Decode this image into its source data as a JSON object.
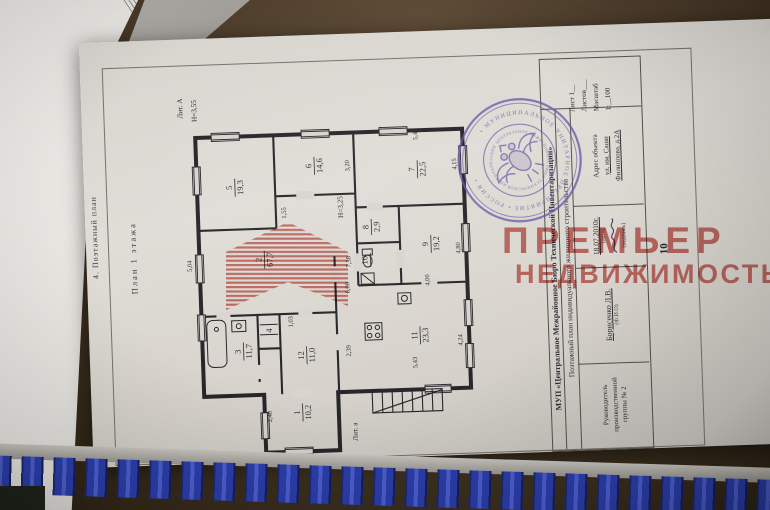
{
  "page": {
    "page_number": "10",
    "section_title": "4. Поэтажный план",
    "plan_title": "План 1 этажа"
  },
  "title_block": {
    "org": "МУП «Центральное Межрайонное Бюро Технической Инвентаризации»",
    "doc_type": "Поэтажный план индивидуального жилищного строительства",
    "sheet_lines": {
      "l1": "Лист 1__",
      "l2": "Листов___",
      "l3": "Масштаб",
      "l4": "1:__100"
    },
    "address": {
      "label": "Адрес объекта",
      "street": "ул. им. Саши",
      "house": "Филиппова, д.2А"
    },
    "date": {
      "value": "18.07.2010г.",
      "caption": "(дата)",
      "sign_caption": "(подпись)"
    },
    "executive": {
      "name": "Борисенко Л.В.",
      "caption": "(Ф.И.О)"
    },
    "role": {
      "l1": "Руководитель",
      "l2": "производственной",
      "l3": "группы № 2"
    }
  },
  "plan": {
    "rooms": [
      {
        "n": "5",
        "a": "19,3"
      },
      {
        "n": "6",
        "a": "14,6"
      },
      {
        "n": "7",
        "a": "22,5"
      },
      {
        "n": "8",
        "a": "2,9"
      },
      {
        "n": "9",
        "a": "19,2"
      },
      {
        "n": "10",
        "a": ""
      },
      {
        "n": "2",
        "a": "67,7"
      },
      {
        "n": "3",
        "a": "11,7"
      },
      {
        "n": "4",
        "a": ""
      },
      {
        "n": "12",
        "a": "11,0"
      },
      {
        "n": "11",
        "a": "23,3"
      },
      {
        "n": "1",
        "a": "10,2"
      }
    ],
    "dims": [
      {
        "t": "Лит. А"
      },
      {
        "t": "Н=3,55"
      },
      {
        "t": "Н=3,25"
      },
      {
        "t": "5,04"
      },
      {
        "t": "1,55"
      },
      {
        "t": "3,20"
      },
      {
        "t": "5,43"
      },
      {
        "t": "4,15"
      },
      {
        "t": "4,80"
      },
      {
        "t": "4,00"
      },
      {
        "t": "4,24"
      },
      {
        "t": "5,43"
      },
      {
        "t": "2,39"
      },
      {
        "t": "1,03"
      },
      {
        "t": "7,58"
      },
      {
        "t": "6,00"
      },
      {
        "t": "2,40"
      },
      {
        "t": "Лит. а"
      }
    ]
  },
  "stamp": {
    "outer_text": "• МУНИЦИПАЛЬНОЕ УНИТАРНОЕ ПРЕДПРИЯТИЕ • РОССИЯ •",
    "inner_text": "ЦЕНТРАЛЬНОЕ МЕЖРАЙОННОЕ БЮРО ТЕХНИЧЕСКОЙ ИНВЕНТАРИЗАЦИИ"
  },
  "watermark": {
    "line1": "ПРЕМЬЕР",
    "line2": "НЕДВИЖИМОСТЬ"
  },
  "colors": {
    "stamp": "#6757a6",
    "watermark": "#c8554e",
    "binding": "#2c3fae",
    "paper": "#d8d5cf"
  }
}
